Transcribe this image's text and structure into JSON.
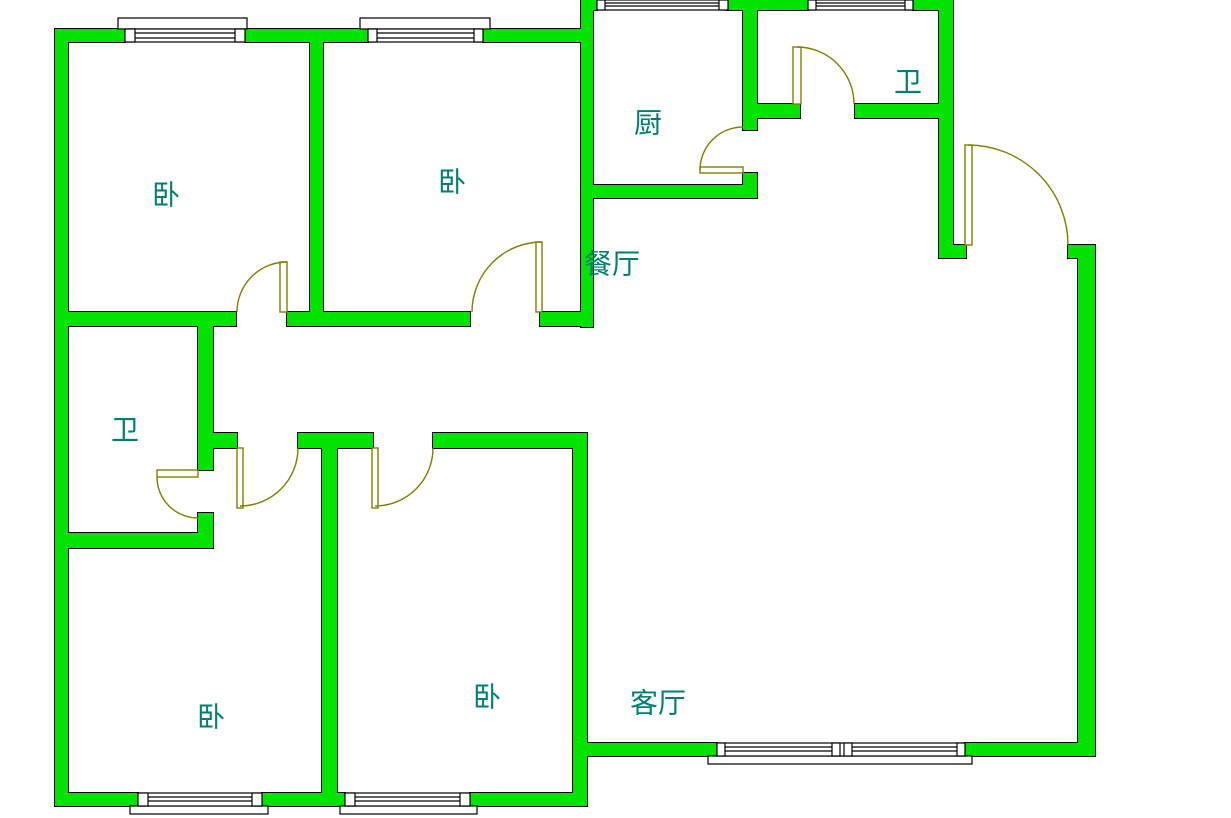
{
  "title": "apartment-floor-plan",
  "palette": {
    "wall_fill": "#00e400",
    "wall_outline": "#000000",
    "door_window_line": "#7f7f00",
    "label_color": "#008070",
    "background": "#ffffff"
  },
  "canvas": {
    "width": 1231,
    "height": 818
  },
  "rooms": [
    {
      "id": "bedroom-top-left",
      "label": "卧",
      "cx": 166,
      "cy": 195
    },
    {
      "id": "bedroom-top-middle",
      "label": "卧",
      "cx": 452,
      "cy": 182
    },
    {
      "id": "kitchen",
      "label": "厨",
      "cx": 648,
      "cy": 123
    },
    {
      "id": "bathroom-top-right",
      "label": "卫",
      "cx": 908,
      "cy": 82
    },
    {
      "id": "dining-room",
      "label": "餐厅",
      "cx": 612,
      "cy": 264
    },
    {
      "id": "bathroom-left",
      "label": "卫",
      "cx": 125,
      "cy": 430
    },
    {
      "id": "bedroom-bottom-left",
      "label": "卧",
      "cx": 211,
      "cy": 717
    },
    {
      "id": "bedroom-bottom-mid",
      "label": "卧",
      "cx": 487,
      "cy": 697
    },
    {
      "id": "living-room",
      "label": "客厅",
      "cx": 658,
      "cy": 703
    }
  ],
  "walls": [
    [
      55,
      29,
      13,
      777
    ],
    [
      55,
      29,
      70,
      13
    ],
    [
      245,
      29,
      123,
      13
    ],
    [
      483,
      29,
      110,
      13
    ],
    [
      581,
      0,
      16,
      10
    ],
    [
      727,
      0,
      81,
      10
    ],
    [
      913,
      0,
      40,
      10
    ],
    [
      581,
      0,
      12,
      327
    ],
    [
      310,
      42,
      13,
      270
    ],
    [
      743,
      0,
      14,
      130
    ],
    [
      743,
      173,
      14,
      25
    ],
    [
      939,
      0,
      14,
      258
    ],
    [
      1078,
      245,
      17,
      511
    ],
    [
      198,
      326,
      15,
      144
    ],
    [
      198,
      513,
      15,
      35
    ],
    [
      322,
      448,
      15,
      345
    ],
    [
      573,
      433,
      14,
      360
    ],
    [
      55,
      312,
      181,
      14
    ],
    [
      287,
      312,
      183,
      14
    ],
    [
      540,
      312,
      53,
      14
    ],
    [
      593,
      185,
      164,
      13
    ],
    [
      757,
      104,
      43,
      14
    ],
    [
      855,
      104,
      98,
      14
    ],
    [
      939,
      245,
      27,
      13
    ],
    [
      1068,
      245,
      27,
      13
    ],
    [
      213,
      433,
      24,
      15
    ],
    [
      298,
      433,
      75,
      15
    ],
    [
      433,
      433,
      152,
      15
    ],
    [
      55,
      533,
      158,
      15
    ],
    [
      55,
      793,
      83,
      13
    ],
    [
      262,
      793,
      83,
      13
    ],
    [
      470,
      793,
      117,
      13
    ],
    [
      587,
      743,
      130,
      13
    ],
    [
      965,
      743,
      130,
      13
    ]
  ],
  "windows": [
    {
      "id": "bedroom-top-left-window",
      "band": [
        125,
        29,
        120,
        13
      ],
      "posts": [
        [
          125,
          29,
          10,
          13
        ],
        [
          235,
          29,
          10,
          13
        ]
      ],
      "lines": [
        [
          135,
          33,
          235,
          33
        ],
        [
          135,
          38,
          235,
          38
        ]
      ],
      "sill": [
        118,
        18,
        129,
        11
      ]
    },
    {
      "id": "bedroom-top-mid-window",
      "band": [
        368,
        29,
        115,
        13
      ],
      "posts": [
        [
          368,
          29,
          9,
          13
        ],
        [
          474,
          29,
          9,
          13
        ]
      ],
      "lines": [
        [
          377,
          33,
          474,
          33
        ],
        [
          377,
          38,
          474,
          38
        ]
      ],
      "sill": [
        360,
        18,
        130,
        11
      ]
    },
    {
      "id": "kitchen-window",
      "band": [
        597,
        0,
        131,
        10
      ],
      "posts": [
        [
          597,
          0,
          8,
          10
        ],
        [
          719,
          0,
          9,
          10
        ]
      ],
      "lines": [
        [
          605,
          3,
          719,
          3
        ],
        [
          605,
          6,
          719,
          6
        ]
      ],
      "sill": null
    },
    {
      "id": "bathroom-top-right-window",
      "band": [
        808,
        0,
        105,
        10
      ],
      "posts": [
        [
          808,
          0,
          8,
          10
        ],
        [
          905,
          0,
          8,
          10
        ]
      ],
      "lines": [
        [
          816,
          3,
          905,
          3
        ],
        [
          816,
          6,
          905,
          6
        ]
      ],
      "sill": null
    },
    {
      "id": "bedroom-bottom-left-window",
      "band": [
        138,
        793,
        124,
        13
      ],
      "posts": [
        [
          138,
          793,
          10,
          13
        ],
        [
          252,
          793,
          10,
          13
        ]
      ],
      "lines": [
        [
          148,
          797,
          252,
          797
        ],
        [
          148,
          801,
          252,
          801
        ]
      ],
      "sill": [
        130,
        806,
        138,
        8
      ]
    },
    {
      "id": "bedroom-bottom-mid-window",
      "band": [
        345,
        793,
        125,
        13
      ],
      "posts": [
        [
          345,
          793,
          10,
          13
        ],
        [
          460,
          793,
          10,
          13
        ]
      ],
      "lines": [
        [
          355,
          797,
          460,
          797
        ],
        [
          355,
          801,
          460,
          801
        ]
      ],
      "sill": [
        340,
        806,
        137,
        8
      ]
    },
    {
      "id": "living-room-window",
      "band": [
        717,
        743,
        248,
        13
      ],
      "posts": [
        [
          717,
          743,
          8,
          13
        ],
        [
          832,
          743,
          8,
          13
        ],
        [
          844,
          743,
          8,
          13
        ],
        [
          957,
          743,
          8,
          13
        ]
      ],
      "lines": [
        [
          725,
          747,
          832,
          747
        ],
        [
          725,
          751,
          832,
          751
        ],
        [
          852,
          747,
          957,
          747
        ],
        [
          852,
          751,
          957,
          751
        ]
      ],
      "sill": [
        708,
        756,
        264,
        8
      ]
    }
  ],
  "doors": [
    {
      "id": "bedroom-top-left-door",
      "panel": [
        280,
        262,
        7,
        50
      ],
      "arc": [
        237,
        312,
        50,
        287,
        262,
        1
      ]
    },
    {
      "id": "bedroom-top-mid-door",
      "panel": [
        536,
        242,
        6,
        70
      ],
      "arc": [
        472,
        312,
        70,
        542,
        242,
        1
      ]
    },
    {
      "id": "bathroom-left-door",
      "panel": [
        157,
        470,
        41,
        7
      ],
      "arc": [
        157,
        477,
        41,
        198,
        518,
        0
      ]
    },
    {
      "id": "bedroom-bottom-left-door",
      "panel": [
        237,
        448,
        6,
        60
      ],
      "arc": [
        240,
        506,
        58,
        298,
        448,
        0
      ]
    },
    {
      "id": "bedroom-bottom-mid-door",
      "panel": [
        372,
        448,
        6,
        60
      ],
      "arc": [
        375,
        506,
        58,
        433,
        448,
        0
      ]
    },
    {
      "id": "kitchen-door",
      "panel": [
        700,
        167,
        43,
        6
      ],
      "arc": [
        700,
        170,
        43,
        743,
        127,
        1
      ]
    },
    {
      "id": "bathroom-top-right-door",
      "panel": [
        793,
        47,
        8,
        57
      ],
      "arc": [
        797,
        47,
        57,
        854,
        104,
        1
      ]
    },
    {
      "id": "entrance-door",
      "panel": [
        965,
        145,
        7,
        100
      ],
      "arc": [
        968,
        145,
        100,
        1068,
        245,
        1
      ]
    }
  ]
}
